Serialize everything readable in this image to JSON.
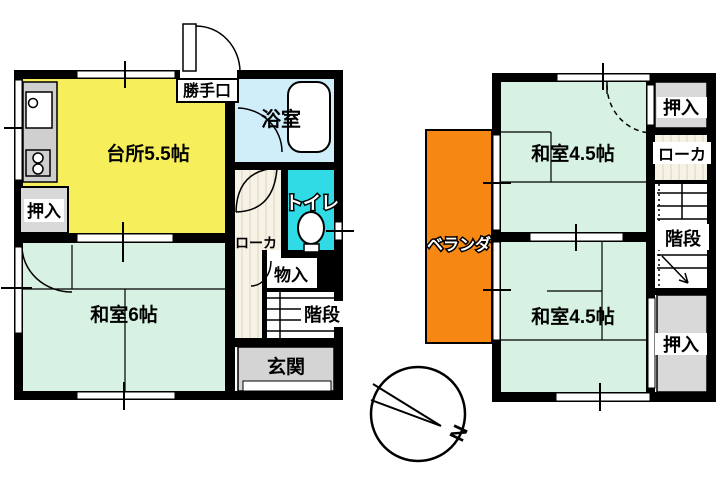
{
  "title": "floor-plan",
  "colors": {
    "wall": "#000000",
    "kitchen": "#f6ef5b",
    "tatami": "#d7f2e3",
    "bath": "#cfeef9",
    "toilet": "#30dbe6",
    "veranda": "#f68712",
    "closet": "#d9d9d9",
    "entrance": "#d4d4d4",
    "hallway": "#f7f2e6",
    "wood_line": "#ded2bd",
    "fixture_gray": "#cfcfcf"
  },
  "floor1": {
    "kitchen": "台所5.5帖",
    "bath": "浴室",
    "toilet": "トイレ",
    "backdoor": "勝手口",
    "closet": "押入",
    "room": "和室6帖",
    "hallway": "ローカ",
    "storage": "物入",
    "stairs": "階段",
    "entrance": "玄関"
  },
  "floor2": {
    "room_upper": "和室4.5帖",
    "room_lower": "和室4.5帖",
    "closet_upper": "押入",
    "closet_lower": "押入",
    "hallway": "ローカ",
    "stairs": "階段",
    "veranda": "ベランダ"
  },
  "compass": {
    "north": "N"
  }
}
